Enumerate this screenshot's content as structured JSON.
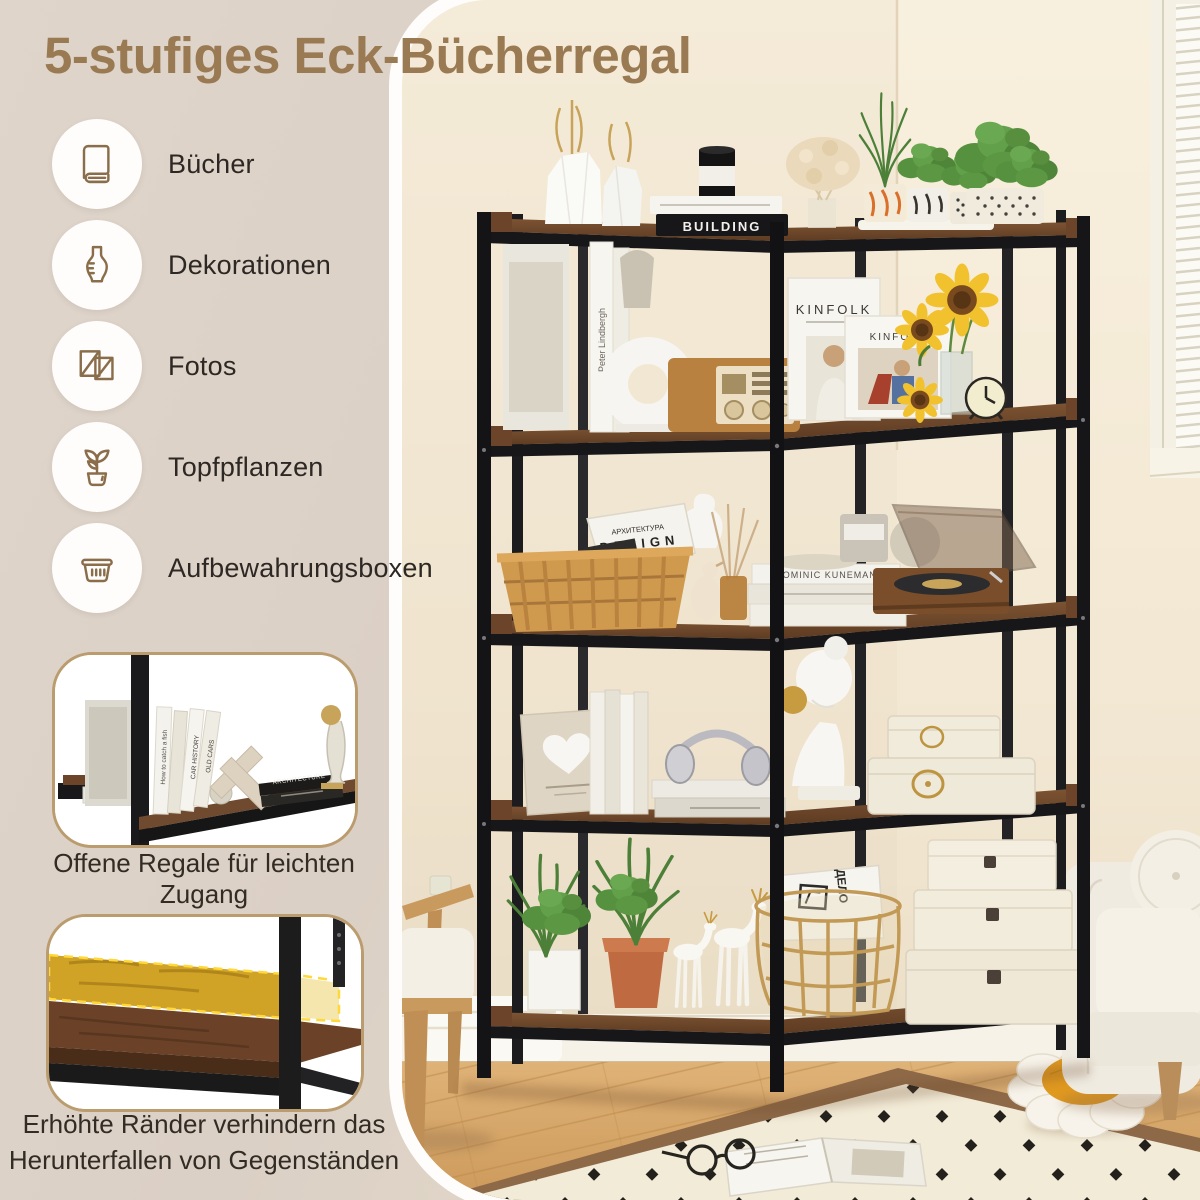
{
  "title": "5-stufiges Eck-Bücherregal",
  "features": {
    "items": [
      {
        "icon": "book-icon",
        "label": "Bücher"
      },
      {
        "icon": "vase-icon",
        "label": "Dekorationen"
      },
      {
        "icon": "picture-frames-icon",
        "label": "Fotos"
      },
      {
        "icon": "potted-plant-icon",
        "label": "Topfpflanzen"
      },
      {
        "icon": "storage-basket-icon",
        "label": "Aufbewahrungsboxen"
      }
    ]
  },
  "callouts": {
    "open_shelves": {
      "caption": "Offene Regale für leichten Zugang",
      "book_texts": [
        "How to catch a fish",
        "CAR HISTORY",
        "OLD CARS",
        "ARCHITECTURE"
      ]
    },
    "raised_edges": {
      "caption": "Erhöhte Ränder verhindern das Herunterfallen von Gegenständen"
    }
  },
  "photo": {
    "texts": {
      "magazine_large": "KINFOLK",
      "magazine_small": "KINFOLK",
      "book_stack_bottom": "BUILDING",
      "book_spine_left": "Peter Lindbergh",
      "basket_magazine_title": "АРХИТЕКТУРА",
      "basket_magazine_subtitle": "DESIGN",
      "books_spine_right": "DOMINIC KUNEMAN",
      "storage_magazine": "ДЕЛО"
    }
  },
  "colors": {
    "title": "#9a7a52",
    "panel_bg": "#dbd0c5",
    "icon_stroke": "#8a6e4b",
    "label_text": "#2d2824",
    "caption_text": "#322c25",
    "inset_border": "#bb9c6e",
    "frame_black": "#1a1a1c",
    "shelf_wood": "#6e482c",
    "wall": "#f5ecda",
    "floor": "#d7a96c",
    "rug": "#f2ebd7",
    "rug_border": "#8e6948",
    "highlight_yellow": "#e3b722",
    "sofa": "#efebe1",
    "plant_green": "#55913e",
    "sunflower": "#f2c12e"
  }
}
